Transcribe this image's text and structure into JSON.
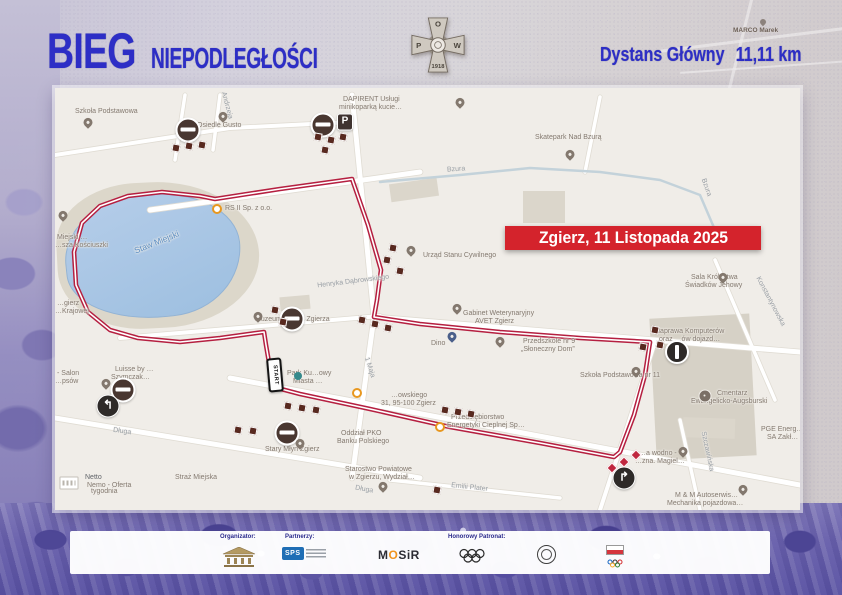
{
  "header": {
    "title_main": "BIEG",
    "title_sub": "NIEPODLEGŁOŚCI",
    "distance_label": "Dystans Główny",
    "distance_value": "11,11 km",
    "accent_color": "#2d2ec6",
    "badge": {
      "p": "P",
      "o": "O",
      "w": "W",
      "year": "1918"
    }
  },
  "banner": {
    "text": "Zgierz, 11 Listopada 2025",
    "bg": "#d4232c"
  },
  "bg_labels": [
    {
      "t": "MARCO Marek",
      "x": 733,
      "y": 27
    }
  ],
  "map": {
    "route_color": "#b51f40",
    "start_sign": "START",
    "route_points": [
      [
        297,
        91
      ],
      [
        313,
        137
      ],
      [
        326,
        182
      ],
      [
        322,
        212
      ],
      [
        319,
        229
      ],
      [
        365,
        236
      ],
      [
        445,
        244
      ],
      [
        525,
        250
      ],
      [
        595,
        254
      ],
      [
        590,
        287
      ],
      [
        579,
        327
      ],
      [
        565,
        364
      ],
      [
        559,
        369
      ],
      [
        485,
        355
      ],
      [
        395,
        339
      ],
      [
        315,
        321
      ],
      [
        245,
        306
      ],
      [
        226,
        301
      ],
      [
        217,
        292
      ],
      [
        211,
        257
      ],
      [
        209,
        244
      ],
      [
        165,
        250
      ],
      [
        125,
        254
      ],
      [
        83,
        250
      ],
      [
        55,
        242
      ],
      [
        33,
        224
      ],
      [
        21,
        197
      ],
      [
        19,
        164
      ],
      [
        27,
        135
      ],
      [
        45,
        118
      ],
      [
        73,
        108
      ],
      [
        107,
        104
      ],
      [
        145,
        108
      ],
      [
        160,
        111
      ],
      [
        225,
        101
      ],
      [
        297,
        91
      ]
    ],
    "streets": [
      {
        "pts": [
          [
            95,
            122
          ],
          [
            365,
            84
          ]
        ],
        "w": 5
      },
      {
        "pts": [
          [
            297,
            7
          ],
          [
            319,
            229
          ],
          [
            297,
            390
          ]
        ],
        "w": 5
      },
      {
        "pts": [
          [
            319,
            229
          ],
          [
            745,
            264
          ]
        ],
        "w": 5
      },
      {
        "pts": [
          [
            600,
            254
          ],
          [
            545,
            422
          ]
        ],
        "w": 4
      },
      {
        "pts": [
          [
            175,
            290
          ],
          [
            745,
            397
          ]
        ],
        "w": 5
      },
      {
        "pts": [
          [
            0,
            330
          ],
          [
            365,
            390
          ]
        ],
        "w": 5
      },
      {
        "pts": [
          [
            65,
            250
          ],
          [
            325,
            228
          ]
        ],
        "w": 4
      },
      {
        "pts": [
          [
            335,
            392
          ],
          [
            505,
            410
          ]
        ],
        "w": 3.5
      },
      {
        "pts": [
          [
            130,
            7
          ],
          [
            120,
            72
          ]
        ],
        "w": 3.5
      },
      {
        "pts": [
          [
            165,
            7
          ],
          [
            158,
            62
          ]
        ],
        "w": 3.5
      },
      {
        "pts": [
          [
            0,
            67
          ],
          [
            175,
            40
          ],
          [
            297,
            34
          ]
        ],
        "w": 4
      },
      {
        "pts": [
          [
            625,
            332
          ],
          [
            645,
            422
          ]
        ],
        "w": 3.5
      },
      {
        "pts": [
          [
            660,
            172
          ],
          [
            720,
            312
          ]
        ],
        "w": 3.5
      },
      {
        "pts": [
          [
            545,
            9
          ],
          [
            530,
            84
          ]
        ],
        "w": 3.5
      },
      {
        "pts": [
          [
            325,
            94
          ],
          [
            405,
            87
          ],
          [
            475,
            80
          ],
          [
            545,
            84
          ],
          [
            605,
            92
          ],
          [
            645,
            107
          ],
          [
            660,
            142
          ]
        ],
        "w": 2.5,
        "river": true
      }
    ],
    "labels": [
      {
        "t": "Szkoła Podstawowa",
        "x": 20,
        "y": 20
      },
      {
        "t": "Osiedle Gusto",
        "x": 142,
        "y": 34
      },
      {
        "t": "Andrzeja",
        "x": 158,
        "y": 14,
        "r": 75,
        "c": "#9aa0a6"
      },
      {
        "t": "DAPIRENT Usługi",
        "x": 288,
        "y": 8
      },
      {
        "t": "minikoparką kucie…",
        "x": 284,
        "y": 16
      },
      {
        "t": "Skatepark Nad Bzurą",
        "x": 480,
        "y": 46
      },
      {
        "t": "Bzura",
        "x": 392,
        "y": 78,
        "r": -4,
        "c": "#9aa0a6"
      },
      {
        "t": "Bzura",
        "x": 642,
        "y": 96,
        "r": 70,
        "c": "#9aa0a6"
      },
      {
        "t": "RS II Sp. z o.o.",
        "x": 170,
        "y": 117
      },
      {
        "t": "Staw Miejski",
        "x": 78,
        "y": 150,
        "r": -22,
        "c": "#5b8ec4",
        "s": 8.5
      },
      {
        "t": "Miejski …",
        "x": 2,
        "y": 146
      },
      {
        "t": "…sza Kościuszki",
        "x": 0,
        "y": 154
      },
      {
        "t": "…gierz",
        "x": 2,
        "y": 212
      },
      {
        "t": "…Krajowej",
        "x": 0,
        "y": 220
      },
      {
        "t": "Urząd Stanu Cywilnego",
        "x": 368,
        "y": 164
      },
      {
        "t": "Henryka Dąbrowskiego",
        "x": 262,
        "y": 190,
        "r": -7,
        "c": "#9aa0a6"
      },
      {
        "t": "Gabinet Weterynaryjny",
        "x": 408,
        "y": 222
      },
      {
        "t": "AVET Zgierz",
        "x": 420,
        "y": 230
      },
      {
        "t": "Dino",
        "x": 376,
        "y": 252
      },
      {
        "t": "Przedszkole nr 9",
        "x": 468,
        "y": 250
      },
      {
        "t": "„Słoneczny Dom”",
        "x": 466,
        "y": 258
      },
      {
        "t": "Szkoła Podstawowa nr 11",
        "x": 525,
        "y": 284
      },
      {
        "t": "Sala Królestwa",
        "x": 636,
        "y": 186
      },
      {
        "t": "Świadków Jehowy",
        "x": 630,
        "y": 194
      },
      {
        "t": "Naprawa Komputerów",
        "x": 600,
        "y": 240
      },
      {
        "t": "oraz …ów dojazd…",
        "x": 604,
        "y": 248
      },
      {
        "t": "Cmentarz",
        "x": 662,
        "y": 302
      },
      {
        "t": "Ewangelicko-Augsburski",
        "x": 636,
        "y": 310
      },
      {
        "t": "PGE Energ…",
        "x": 706,
        "y": 338
      },
      {
        "t": "SA Zakł…",
        "x": 712,
        "y": 346
      },
      {
        "t": "…a wodno -",
        "x": 584,
        "y": 362
      },
      {
        "t": "…zna. Magiel…",
        "x": 580,
        "y": 370
      },
      {
        "t": "M & M Autoserwis…",
        "x": 620,
        "y": 404
      },
      {
        "t": "Mechanika pojazdowa…",
        "x": 612,
        "y": 412
      },
      {
        "t": "Szczawińska",
        "x": 632,
        "y": 360,
        "r": 78,
        "c": "#9aa0a6"
      },
      {
        "t": "Emilii Plater",
        "x": 396,
        "y": 396,
        "r": 6,
        "c": "#9aa0a6"
      },
      {
        "t": "Starostwo Powiatowe",
        "x": 290,
        "y": 378
      },
      {
        "t": "w Zgierzu, Wydział…",
        "x": 294,
        "y": 386
      },
      {
        "t": "Oddział PKO",
        "x": 286,
        "y": 342
      },
      {
        "t": "Banku Polskiego",
        "x": 282,
        "y": 350
      },
      {
        "t": "Długa",
        "x": 58,
        "y": 340,
        "r": 8,
        "c": "#9aa0a6"
      },
      {
        "t": "Długa",
        "x": 300,
        "y": 398,
        "r": 10,
        "c": "#9aa0a6"
      },
      {
        "t": "Straż Miejska",
        "x": 120,
        "y": 386
      },
      {
        "t": "Netto",
        "x": 30,
        "y": 386,
        "c": "#5f6368"
      },
      {
        "t": "Nemo - Oferta",
        "x": 32,
        "y": 394
      },
      {
        "t": "tygodnia",
        "x": 36,
        "y": 400
      },
      {
        "t": "Luisse by …",
        "x": 60,
        "y": 278
      },
      {
        "t": "Szymczak…",
        "x": 56,
        "y": 286
      },
      {
        "t": "- Salon",
        "x": 2,
        "y": 282
      },
      {
        "t": "…psów",
        "x": 0,
        "y": 290
      },
      {
        "t": "Stary Młyn Zgierz",
        "x": 210,
        "y": 358
      },
      {
        "t": "Park Ku…owy",
        "x": 232,
        "y": 282
      },
      {
        "t": "Miasta …",
        "x": 238,
        "y": 290
      },
      {
        "t": "Muzeum Miasta Zgierza",
        "x": 200,
        "y": 228
      },
      {
        "t": "…owskiego",
        "x": 336,
        "y": 304
      },
      {
        "t": "31, 95-100 Zgierz",
        "x": 326,
        "y": 312
      },
      {
        "t": "Przedsiębiorstwo",
        "x": 396,
        "y": 326
      },
      {
        "t": "Energetyki Cieplnej Sp…",
        "x": 392,
        "y": 334
      },
      {
        "t": "1 Maja",
        "x": 304,
        "y": 276,
        "r": 72,
        "c": "#9aa0a6"
      },
      {
        "t": "Konstantynowska",
        "x": 688,
        "y": 210,
        "r": 62,
        "c": "#9aa0a6"
      }
    ],
    "icons": [
      {
        "k": "pin",
        "x": 33,
        "y": 38
      },
      {
        "k": "pin",
        "x": 168,
        "y": 32
      },
      {
        "k": "noentry",
        "x": 133,
        "y": 42
      },
      {
        "k": "noentry",
        "x": 268,
        "y": 37
      },
      {
        "k": "parking",
        "x": 290,
        "y": 34,
        "t": "P"
      },
      {
        "k": "pin",
        "x": 405,
        "y": 18
      },
      {
        "k": "pin",
        "x": 515,
        "y": 70
      },
      {
        "k": "pin",
        "x": 8,
        "y": 131
      },
      {
        "k": "odot",
        "x": 162,
        "y": 121
      },
      {
        "k": "pin",
        "x": 356,
        "y": 166
      },
      {
        "k": "pin",
        "x": 402,
        "y": 224
      },
      {
        "k": "pinb",
        "x": 397,
        "y": 252
      },
      {
        "k": "pin",
        "x": 445,
        "y": 257
      },
      {
        "k": "pin",
        "x": 581,
        "y": 287
      },
      {
        "k": "pin",
        "x": 668,
        "y": 193
      },
      {
        "k": "oneway",
        "x": 622,
        "y": 264
      },
      {
        "k": "pini",
        "x": 650,
        "y": 308
      },
      {
        "k": "pin",
        "x": 628,
        "y": 367
      },
      {
        "k": "turnright",
        "x": 569,
        "y": 390,
        "t": "↱"
      },
      {
        "k": "pin",
        "x": 688,
        "y": 405
      },
      {
        "k": "pin",
        "x": 51,
        "y": 299
      },
      {
        "k": "noentry",
        "x": 68,
        "y": 302
      },
      {
        "k": "turnleft",
        "x": 53,
        "y": 318,
        "t": "↰"
      },
      {
        "k": "noentry",
        "x": 237,
        "y": 231
      },
      {
        "k": "pin",
        "x": 203,
        "y": 232
      },
      {
        "k": "noentry",
        "x": 232,
        "y": 345
      },
      {
        "k": "pin",
        "x": 245,
        "y": 359
      },
      {
        "k": "pin",
        "x": 328,
        "y": 402
      },
      {
        "k": "start",
        "x": 220,
        "y": 287,
        "t": "START"
      },
      {
        "k": "park",
        "x": 243,
        "y": 288
      },
      {
        "k": "odot",
        "x": 302,
        "y": 305
      },
      {
        "k": "odot",
        "x": 385,
        "y": 339
      },
      {
        "k": "netto",
        "x": 14,
        "y": 395
      },
      {
        "k": "sq",
        "x": 121,
        "y": 60
      },
      {
        "k": "sq",
        "x": 134,
        "y": 58
      },
      {
        "k": "sq",
        "x": 147,
        "y": 57
      },
      {
        "k": "sq",
        "x": 263,
        "y": 49
      },
      {
        "k": "sq",
        "x": 276,
        "y": 52
      },
      {
        "k": "sq",
        "x": 288,
        "y": 49
      },
      {
        "k": "sq",
        "x": 270,
        "y": 62
      },
      {
        "k": "sq",
        "x": 338,
        "y": 160
      },
      {
        "k": "sq",
        "x": 332,
        "y": 172
      },
      {
        "k": "sq",
        "x": 345,
        "y": 183
      },
      {
        "k": "sq",
        "x": 307,
        "y": 232
      },
      {
        "k": "sq",
        "x": 320,
        "y": 236
      },
      {
        "k": "sq",
        "x": 333,
        "y": 240
      },
      {
        "k": "sq",
        "x": 600,
        "y": 242
      },
      {
        "k": "sq",
        "x": 588,
        "y": 259
      },
      {
        "k": "sq",
        "x": 605,
        "y": 257
      },
      {
        "k": "sq",
        "x": 390,
        "y": 322
      },
      {
        "k": "sq",
        "x": 403,
        "y": 324
      },
      {
        "k": "sq",
        "x": 416,
        "y": 326
      },
      {
        "k": "sq",
        "x": 233,
        "y": 318
      },
      {
        "k": "sq",
        "x": 247,
        "y": 320
      },
      {
        "k": "sq",
        "x": 261,
        "y": 322
      },
      {
        "k": "sq",
        "x": 183,
        "y": 342
      },
      {
        "k": "sq",
        "x": 198,
        "y": 343
      },
      {
        "k": "sq",
        "x": 220,
        "y": 222
      },
      {
        "k": "sq",
        "x": 228,
        "y": 234
      },
      {
        "k": "sq",
        "x": 382,
        "y": 402
      },
      {
        "k": "rdia",
        "x": 557,
        "y": 380
      },
      {
        "k": "rdia",
        "x": 569,
        "y": 374
      },
      {
        "k": "rdia",
        "x": 581,
        "y": 367
      }
    ]
  },
  "footer": {
    "labels": [
      "Organizator:",
      "Partnerzy:",
      "Honorowy Patronat:"
    ],
    "sps": "SPS",
    "mosir": [
      "M",
      "O",
      "SiR"
    ]
  }
}
